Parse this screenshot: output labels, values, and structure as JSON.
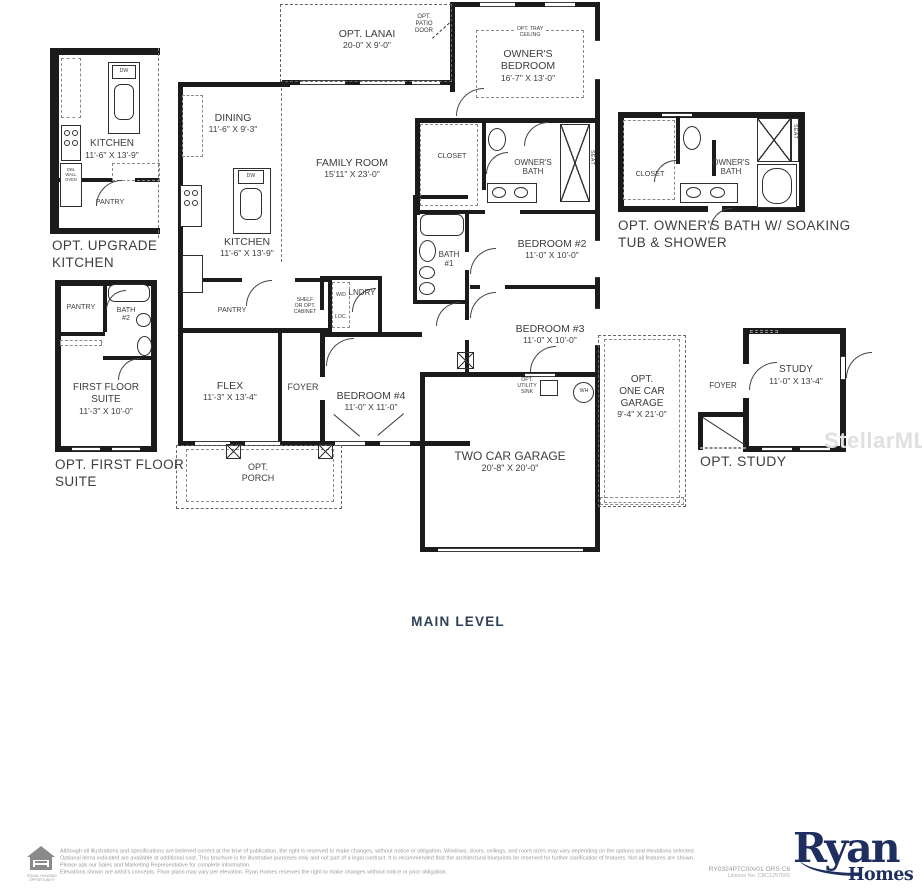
{
  "level_label": "MAIN LEVEL",
  "watermark": "StellarMLS",
  "colors": {
    "wall": "#1b1b1b",
    "label": "#3d3d3d",
    "level_navy": "#2f4156",
    "brand_navy": "#1d2e5f",
    "footer_gray": "#9b9b9b",
    "watermark_gray": "#e0e0e0"
  },
  "plan": {
    "rooms": {
      "dining": {
        "name": "DINING",
        "dims": "11'-6\" X 9'-3\""
      },
      "family_room": {
        "name": "FAMILY ROOM",
        "dims": "15'11\" X 23'-0\""
      },
      "kitchen": {
        "name": "KITCHEN",
        "dims": "11'-6\" X 13'-9\""
      },
      "owners_bedroom": {
        "l1": "OWNER'S",
        "l2": "BEDROOM",
        "dims": "16'-7\" X 13'-0\""
      },
      "owners_bath": {
        "l1": "OWNER'S",
        "l2": "BATH"
      },
      "closet": {
        "name": "CLOSET"
      },
      "bath1": {
        "l1": "BATH",
        "l2": "#1"
      },
      "bedroom2": {
        "name": "BEDROOM #2",
        "dims": "11'-0\" X 10'-0\""
      },
      "bedroom3": {
        "name": "BEDROOM #3",
        "dims": "11'-0\" X 10'-0\""
      },
      "bedroom4": {
        "name": "BEDROOM #4",
        "dims": "11'-0\" X 11'-0\""
      },
      "flex": {
        "name": "FLEX",
        "dims": "11'-3\" X 13'-4\""
      },
      "foyer": {
        "name": "FOYER"
      },
      "pantry": {
        "name": "PANTRY"
      },
      "laundry": {
        "name": "LNDRY"
      },
      "two_car_garage": {
        "name": "TWO CAR GARAGE",
        "dims": "20'-8\" X 20'-0\""
      }
    },
    "annotations": {
      "opt_lanai": {
        "name": "OPT. LANAI",
        "dims": "20-0\" X 9'-0\""
      },
      "opt_patio_door": {
        "l1": "OPT.",
        "l2": "PATIO",
        "l3": "DOOR"
      },
      "opt_tray_ceiling": {
        "l1": "OPT. TRAY",
        "l2": "CEILING"
      },
      "opt_porch": {
        "l1": "OPT.",
        "l2": "PORCH"
      },
      "opt_one_car_garage": {
        "l1": "OPT.",
        "l2": "ONE CAR",
        "l3": "GARAGE",
        "dims": "9'-4\" X 21'-0\""
      },
      "opt_utility_sink": {
        "l1": "OPT.",
        "l2": "UTILITY",
        "l3": "SINK"
      },
      "shelf_or_opt_cabinet": {
        "l1": "SHELF",
        "l2": "OR OPT.",
        "l3": "CABINET"
      },
      "wd": "W/D",
      "loc": "LOC.",
      "wh": "WH",
      "seat": "SEAT",
      "dw": "DW",
      "dbl_wall_oven": {
        "l1": "DBL",
        "l2": "WALL",
        "l3": "OVEN"
      }
    }
  },
  "options": {
    "upgrade_kitchen": {
      "caption_l1": "OPT. UPGRADE",
      "caption_l2": "KITCHEN",
      "kitchen_name": "KITCHEN",
      "kitchen_dims": "11'-6\" X 13'-9\"",
      "pantry": "PANTRY",
      "dw": "DW"
    },
    "first_floor_suite": {
      "caption_l1": "OPT. FIRST FLOOR",
      "caption_l2": "SUITE",
      "suite_l1": "FIRST FLOOR",
      "suite_l2": "SUITE",
      "suite_dims": "11'-3\" X 10'-0\"",
      "pantry": "PANTRY",
      "bath_l1": "BATH",
      "bath_l2": "#2"
    },
    "owners_bath": {
      "caption_l1": "OPT. OWNER'S BATH W/ SOAKING",
      "caption_l2": "TUB & SHOWER",
      "closet": "CLOSET",
      "bath_l1": "OWNER'S",
      "bath_l2": "BATH",
      "seat": "SEAT"
    },
    "study": {
      "caption": "OPT. STUDY",
      "study_name": "STUDY",
      "study_dims": "11'-0\" X 13'-4\"",
      "foyer": "FOYER"
    }
  },
  "footer": {
    "disclaimer_p1": "Although all illustrations and specifications are believed correct at the time of publication, the right is reserved to make changes, without notice or obligation. Windows, doors, ceilings, and room sizes may vary depending on the options and elevations selected. Optional items indicated are available at additional cost. This brochure is for illustrative purposes only and not part of a legal contract. It is recommended that the architectural blueprints be reserved for further clarification of features. Not all features are shown. Please ask our Sales and Marketing Representative for complete information.",
    "disclaimer_p2": "Elevations shown are artist's concepts. Floor plans may vary per elevation. Ryan Homes reserves the right to make changes without notice or prior obligation.",
    "plan_code": "RY0324PTC00v01 ORS C6",
    "license": "License No. CBC1257565",
    "brand_top": "Ryan",
    "brand_bottom": "Homes",
    "equal_housing": "EQUAL HOUSING OPPORTUNITY"
  }
}
